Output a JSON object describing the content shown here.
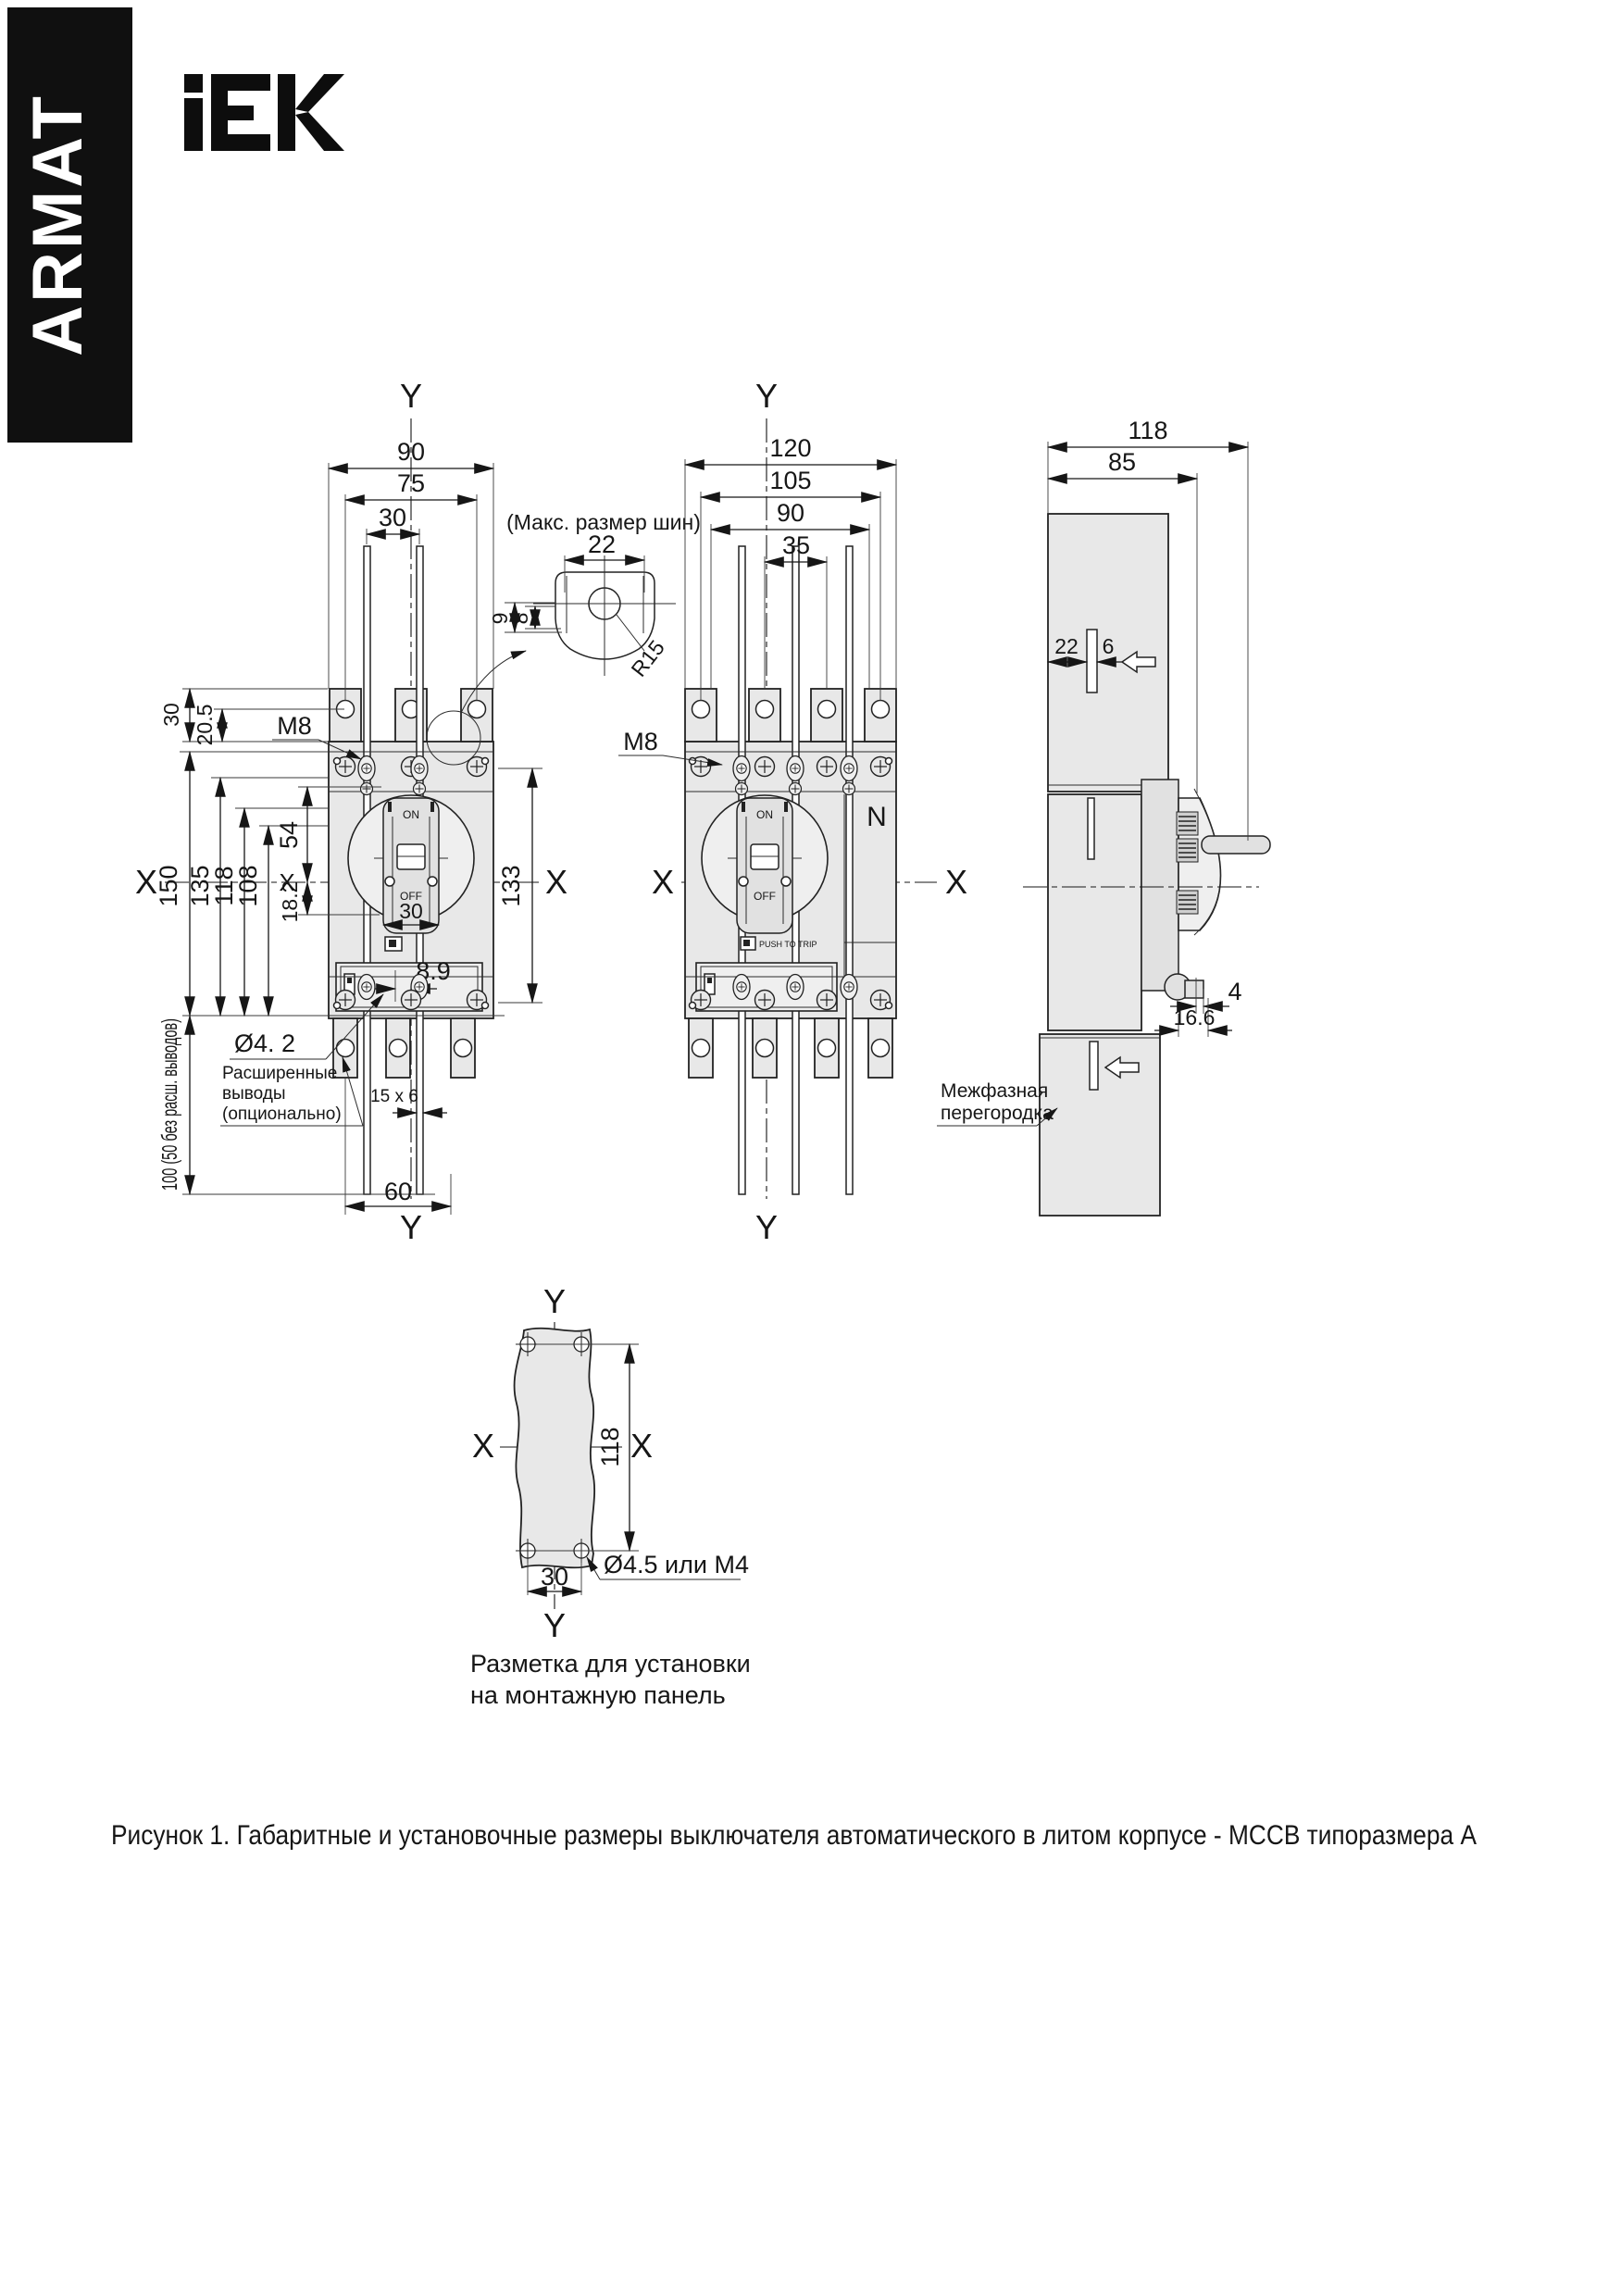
{
  "page": {
    "background": "#ffffff",
    "line_color": "#1c1c1c",
    "body_fill": "#e8e8e8",
    "banner_color": "#101010"
  },
  "brand": {
    "armat": "ARMAT",
    "iek_alt": "IEK logo"
  },
  "common": {
    "x": "X",
    "y": "Y",
    "on": "ON",
    "off": "OFF",
    "m8": "M8"
  },
  "front_view": {
    "dims": {
      "w_total": "90",
      "w_holes": "75",
      "w_bars": "30",
      "h_tab": "30",
      "h_tab2": "20.5",
      "h_total": "150",
      "h1": "135",
      "h2": "118",
      "h3": "108",
      "h4": "54",
      "h5": "18.2",
      "h_right": "133",
      "mech": "8.9",
      "toggle_w": "30",
      "w_poles": "60",
      "bar_section": "15 x 6",
      "h_bars": "100 (50 без расш. выводов)",
      "hole": "Ø4. 2"
    },
    "labels": {
      "ext1": "Расширенные",
      "ext2": "выводы",
      "ext3": "(опционально)"
    }
  },
  "bus_detail": {
    "title": "(Макс. размер шин)",
    "w": "22",
    "h_out": "9",
    "h_in": "8",
    "radius": "R15"
  },
  "four_pole_view": {
    "dims": {
      "w_total": "120",
      "w_holes": "105",
      "w_bars": "90",
      "pitch": "35"
    },
    "labels": {
      "neutral": "N",
      "trip": "PUSH TO TRIP"
    }
  },
  "side_view": {
    "dims": {
      "depth_total": "118",
      "depth_body": "85",
      "slot_offset": "22",
      "slot_width": "6",
      "step": "4",
      "step2": "16.6"
    },
    "labels": {
      "barrier1": "Межфазная",
      "barrier2": "перегородка"
    }
  },
  "panel_view": {
    "dims": {
      "h_holes": "118",
      "w_holes": "30",
      "hole": "Ø4.5 или М4"
    },
    "caption1": "Разметка для установки",
    "caption2": "на монтажную панель"
  },
  "figure_caption": "Рисунок 1. Габаритные и установочные размеры выключателя автоматического в литом корпусе - MCCB типоразмера А"
}
